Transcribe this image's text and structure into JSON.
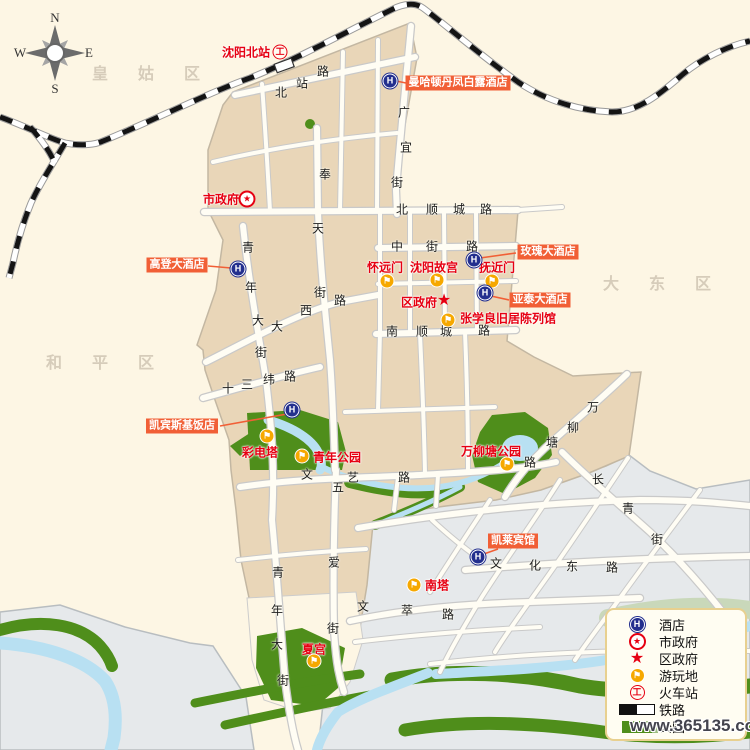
{
  "watermark": "www.365135.com",
  "compass": {
    "n": "N",
    "s": "S",
    "e": "E",
    "w": "W",
    "letters": [
      {
        "t": "N",
        "x": 55,
        "y": 18
      },
      {
        "t": "S",
        "x": 55,
        "y": 89
      },
      {
        "t": "W",
        "x": 20,
        "y": 53
      },
      {
        "t": "E",
        "x": 89,
        "y": 53
      }
    ]
  },
  "districts": [
    {
      "name": "皇姑区",
      "x": 146,
      "y": 72
    },
    {
      "name": "大东区",
      "x": 657,
      "y": 282
    },
    {
      "name": "和平区",
      "x": 100,
      "y": 361
    }
  ],
  "stations": [
    {
      "name": "沈阳北站",
      "x": 246,
      "y": 52,
      "icon_x": 280,
      "icon_y": 52
    }
  ],
  "government": [
    {
      "name": "市政府",
      "type": "city",
      "x": 221,
      "y": 199,
      "icon_x": 247,
      "icon_y": 199
    },
    {
      "name": "区政府",
      "type": "district",
      "x": 419,
      "y": 302,
      "icon_x": 444,
      "icon_y": 301
    }
  ],
  "attractions": [
    {
      "name": "怀远门",
      "x": 385,
      "y": 267,
      "icon_x": 387,
      "icon_y": 281
    },
    {
      "name": "沈阳故宫",
      "x": 434,
      "y": 267,
      "icon_x": 437,
      "icon_y": 280
    },
    {
      "name": "抚近门",
      "x": 497,
      "y": 267,
      "icon_x": 492,
      "icon_y": 281
    },
    {
      "name": "张学良旧居陈列馆",
      "x": 508,
      "y": 318,
      "icon_x": 448,
      "icon_y": 320
    },
    {
      "name": "彩电塔",
      "x": 260,
      "y": 452,
      "icon_x": 267,
      "icon_y": 436
    },
    {
      "name": "青年公园",
      "x": 337,
      "y": 457,
      "icon_x": 302,
      "icon_y": 456
    },
    {
      "name": "万柳塘公园",
      "x": 491,
      "y": 451,
      "icon_x": 507,
      "icon_y": 464
    },
    {
      "name": "南塔",
      "x": 437,
      "y": 585,
      "icon_x": 414,
      "icon_y": 585
    },
    {
      "name": "夏宫",
      "x": 314,
      "y": 649,
      "icon_x": 314,
      "icon_y": 661
    }
  ],
  "hotels": [
    {
      "name": "曼哈顿丹凤白露酒店",
      "chip_x": 458,
      "chip_y": 83,
      "icon_x": 390,
      "icon_y": 81,
      "leader": [
        396,
        81,
        406,
        83
      ]
    },
    {
      "name": "玫瑰大酒店",
      "chip_x": 548,
      "chip_y": 252,
      "icon_x": 474,
      "icon_y": 260,
      "leader": [
        480,
        258,
        516,
        253
      ]
    },
    {
      "name": "亚泰大酒店",
      "chip_x": 540,
      "chip_y": 300,
      "icon_x": 485,
      "icon_y": 293,
      "leader": [
        491,
        296,
        509,
        300
      ]
    },
    {
      "name": "高登大酒店",
      "chip_x": 177,
      "chip_y": 265,
      "icon_x": 238,
      "icon_y": 269,
      "leader": [
        208,
        266,
        231,
        268
      ]
    },
    {
      "name": "凯宾斯基饭店",
      "chip_x": 182,
      "chip_y": 426,
      "icon_x": 292,
      "icon_y": 410,
      "leader": [
        220,
        426,
        287,
        414
      ]
    },
    {
      "name": "凯莱宾馆",
      "chip_x": 513,
      "chip_y": 541,
      "icon_x": 478,
      "icon_y": 557,
      "leader": [
        498,
        549,
        481,
        555
      ]
    }
  ],
  "road_labels": [
    {
      "name": "北站路",
      "chars": [
        {
          "c": "北",
          "x": 281,
          "y": 92
        },
        {
          "c": "站",
          "x": 302,
          "y": 83
        },
        {
          "c": "路",
          "x": 323,
          "y": 71
        }
      ]
    },
    {
      "name": "广宜街",
      "chars": [
        {
          "c": "广",
          "x": 404,
          "y": 112
        },
        {
          "c": "宜",
          "x": 406,
          "y": 147
        },
        {
          "c": "街",
          "x": 397,
          "y": 182
        }
      ]
    },
    {
      "name": "奉天街",
      "chars": [
        {
          "c": "奉",
          "x": 325,
          "y": 174
        },
        {
          "c": "天",
          "x": 318,
          "y": 228
        },
        {
          "c": "街",
          "x": 320,
          "y": 292
        }
      ]
    },
    {
      "name": "北顺城路",
      "chars": [
        {
          "c": "北",
          "x": 402,
          "y": 209
        },
        {
          "c": "顺",
          "x": 432,
          "y": 209
        },
        {
          "c": "城",
          "x": 459,
          "y": 209
        },
        {
          "c": "路",
          "x": 486,
          "y": 209
        }
      ]
    },
    {
      "name": "中街路",
      "chars": [
        {
          "c": "中",
          "x": 397,
          "y": 246
        },
        {
          "c": "街",
          "x": 432,
          "y": 246
        },
        {
          "c": "路",
          "x": 472,
          "y": 246
        }
      ]
    },
    {
      "name": "南顺城路",
      "chars": [
        {
          "c": "南",
          "x": 392,
          "y": 331
        },
        {
          "c": "顺",
          "x": 422,
          "y": 331
        },
        {
          "c": "城",
          "x": 446,
          "y": 331
        },
        {
          "c": "路",
          "x": 484,
          "y": 330
        }
      ]
    },
    {
      "name": "青年大街",
      "chars": [
        {
          "c": "青",
          "x": 248,
          "y": 247
        },
        {
          "c": "年",
          "x": 251,
          "y": 287
        },
        {
          "c": "大",
          "x": 258,
          "y": 320
        },
        {
          "c": "街",
          "x": 261,
          "y": 352
        }
      ]
    },
    {
      "name": "大西路",
      "chars": [
        {
          "c": "大",
          "x": 277,
          "y": 326
        },
        {
          "c": "西",
          "x": 306,
          "y": 310
        },
        {
          "c": "路",
          "x": 340,
          "y": 300
        }
      ]
    },
    {
      "name": "十三纬路",
      "chars": [
        {
          "c": "十",
          "x": 228,
          "y": 388
        },
        {
          "c": "三",
          "x": 247,
          "y": 384
        },
        {
          "c": "纬",
          "x": 269,
          "y": 379
        },
        {
          "c": "路",
          "x": 290,
          "y": 376
        }
      ]
    },
    {
      "name": "文艺路",
      "chars": [
        {
          "c": "文",
          "x": 307,
          "y": 474
        },
        {
          "c": "艺",
          "x": 353,
          "y": 477
        },
        {
          "c": "路",
          "x": 404,
          "y": 477
        }
      ]
    },
    {
      "name": "五爱街",
      "chars": [
        {
          "c": "五",
          "x": 338,
          "y": 487
        },
        {
          "c": "爱",
          "x": 334,
          "y": 562
        },
        {
          "c": "街",
          "x": 333,
          "y": 628
        }
      ]
    },
    {
      "name": "青年大街",
      "chars": [
        {
          "c": "青",
          "x": 278,
          "y": 572
        },
        {
          "c": "年",
          "x": 277,
          "y": 610
        },
        {
          "c": "大",
          "x": 277,
          "y": 644
        },
        {
          "c": "街",
          "x": 283,
          "y": 680
        }
      ]
    },
    {
      "name": "文萃路",
      "chars": [
        {
          "c": "文",
          "x": 363,
          "y": 606
        },
        {
          "c": "萃",
          "x": 407,
          "y": 610
        },
        {
          "c": "路",
          "x": 448,
          "y": 614
        }
      ]
    },
    {
      "name": "文化东路",
      "chars": [
        {
          "c": "文",
          "x": 496,
          "y": 563
        },
        {
          "c": "化",
          "x": 535,
          "y": 565
        },
        {
          "c": "东",
          "x": 572,
          "y": 566
        },
        {
          "c": "路",
          "x": 612,
          "y": 567
        }
      ]
    },
    {
      "name": "万柳塘路",
      "chars": [
        {
          "c": "万",
          "x": 593,
          "y": 407
        },
        {
          "c": "柳",
          "x": 573,
          "y": 427
        },
        {
          "c": "塘",
          "x": 552,
          "y": 442
        },
        {
          "c": "路",
          "x": 530,
          "y": 462
        }
      ]
    },
    {
      "name": "长青街",
      "chars": [
        {
          "c": "长",
          "x": 598,
          "y": 479
        },
        {
          "c": "青",
          "x": 628,
          "y": 508
        },
        {
          "c": "街",
          "x": 657,
          "y": 539
        }
      ]
    }
  ],
  "legend": {
    "items": [
      {
        "icon": "hotel",
        "label": "酒店"
      },
      {
        "icon": "city-gov",
        "label": "市政府"
      },
      {
        "icon": "district-gov",
        "label": "区政府"
      },
      {
        "icon": "attraction",
        "label": "游玩地"
      },
      {
        "icon": "train-station",
        "label": "火车站"
      },
      {
        "icon": "railway",
        "label": "铁路"
      },
      {
        "icon": "park",
        "label": "公园"
      }
    ]
  },
  "icon_glyphs": {
    "hotel": "H",
    "attraction": "⚑",
    "train": "工",
    "star": "★"
  },
  "colors": {
    "urban": "#e9d6b8",
    "background": "#fdf6e4",
    "other_area": "#e6e9eb",
    "park": "#4f8e1b",
    "water": "#b8e0f2",
    "hotel_chip": "#f15f36",
    "poi_red": "#e60012",
    "hotel_blue": "#232f8e",
    "attraction_orange": "#f6a800"
  }
}
